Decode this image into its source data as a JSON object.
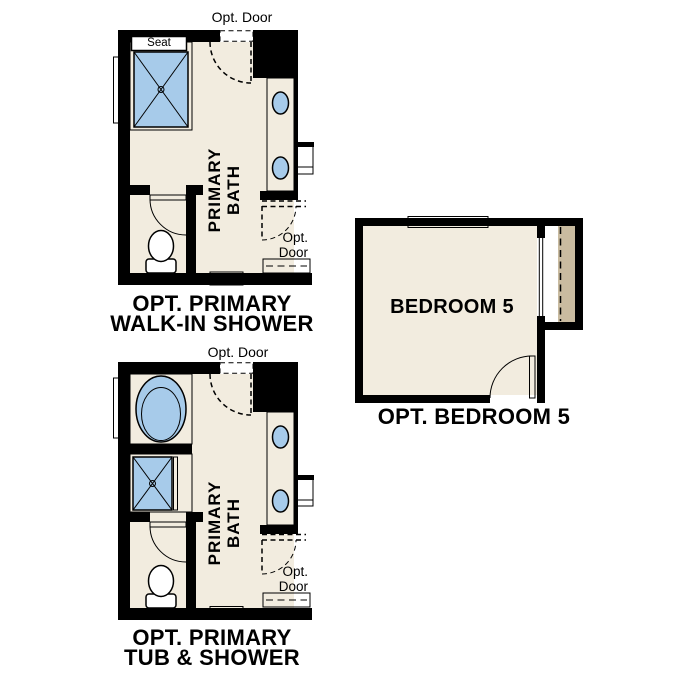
{
  "colors": {
    "wall": "#000000",
    "floor": "#f2ecdf",
    "tan": "#c9bba0",
    "blue": "#a7cbea",
    "background": "#ffffff",
    "text": "#000000"
  },
  "plans": {
    "walkin": {
      "caption_line1": "OPT. PRIMARY",
      "caption_line2": "WALK-IN SHOWER",
      "room_label_line1": "PRIMARY",
      "room_label_line2": "BATH",
      "top_door_label": "Opt. Door",
      "side_door_label_line1": "Opt.",
      "side_door_label_line2": "Door",
      "seat_label": "Seat"
    },
    "tubshower": {
      "caption_line1": "OPT. PRIMARY",
      "caption_line2": "TUB & SHOWER",
      "room_label_line1": "PRIMARY",
      "room_label_line2": "BATH",
      "top_door_label": "Opt. Door",
      "side_door_label_line1": "Opt.",
      "side_door_label_line2": "Door"
    },
    "bedroom": {
      "caption": "OPT. BEDROOM 5",
      "room_label": "BEDROOM 5"
    }
  }
}
